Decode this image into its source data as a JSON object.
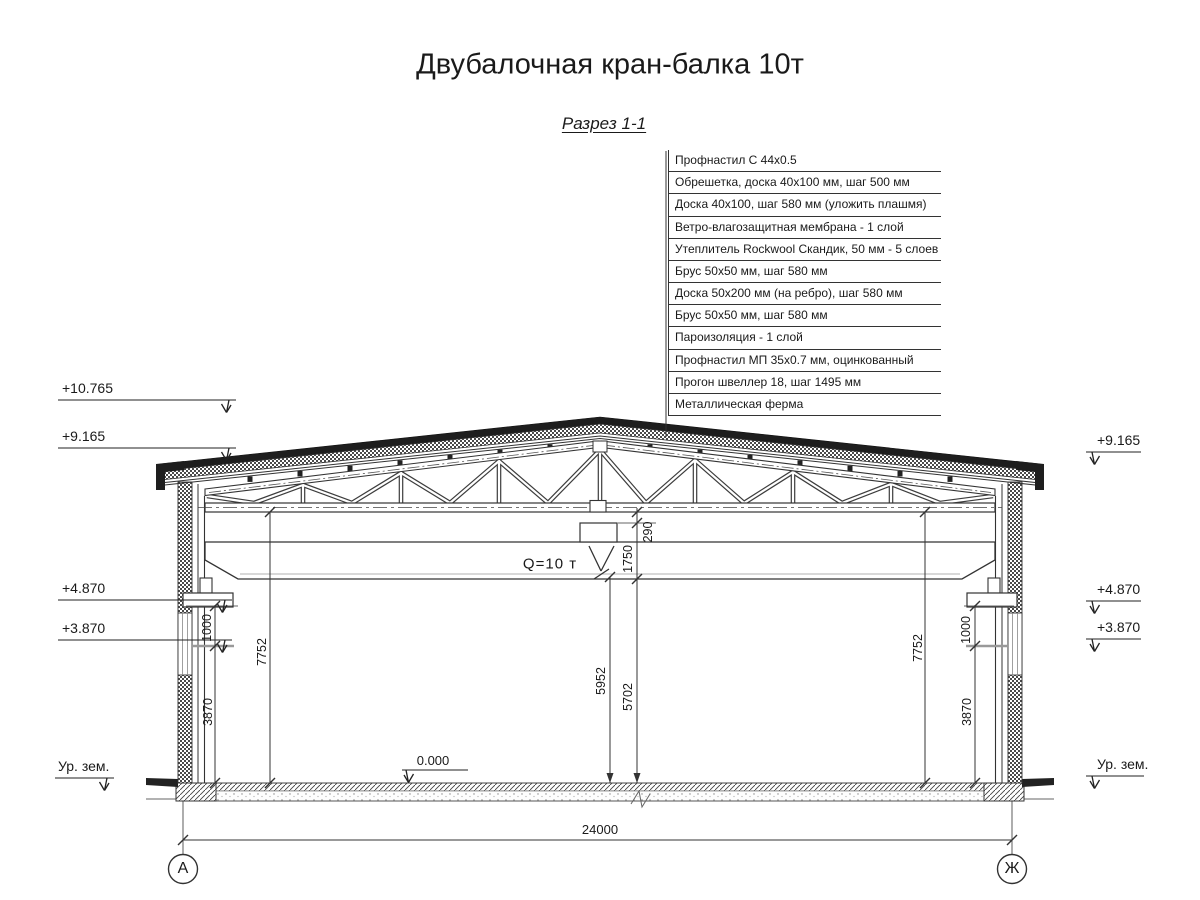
{
  "title": "Двубалочная кран-балка 10т",
  "section_label": "Разрез 1-1",
  "callouts": [
    "Профнастил С 44х0.5",
    "Обрешетка, доска 40х100 мм, шаг 500 мм",
    "Доска 40х100, шаг 580 мм (уложить плашмя)",
    "Ветро-влагозащитная мембрана - 1 слой",
    "Утеплитель Rockwool Скандик, 50 мм - 5 слоев",
    "Брус 50х50 мм, шаг 580 мм",
    "Доска 50х200 мм (на ребро), шаг 580 мм",
    "Брус 50х50 мм, шаг 580 мм",
    "Пароизоляция - 1 слой",
    "Профнастил МП 35х0.7 мм, оцинкованный",
    "Прогон швеллер 18, шаг 1495 мм",
    "Металлическая ферма"
  ],
  "elevations_left": [
    "+10.765",
    "+9.165",
    "+4.870",
    "+3.870",
    "Ур. зем."
  ],
  "elevations_right": [
    "+9.165",
    "+4.870",
    "+3.870",
    "Ур. зем."
  ],
  "crane": {
    "capacity_label": "Q=10 т"
  },
  "dims": {
    "span": "24000",
    "floor_level": "0.000",
    "d290": "290",
    "d1750": "1750",
    "d5952": "5952",
    "d5702": "5702",
    "d7752": "7752",
    "d1000": "1000",
    "d3870": "3870"
  },
  "axes": {
    "left": "А",
    "right": "Ж"
  },
  "colors": {
    "line": "#333333",
    "dark_fill": "#1e1e1e",
    "background": "#ffffff"
  }
}
